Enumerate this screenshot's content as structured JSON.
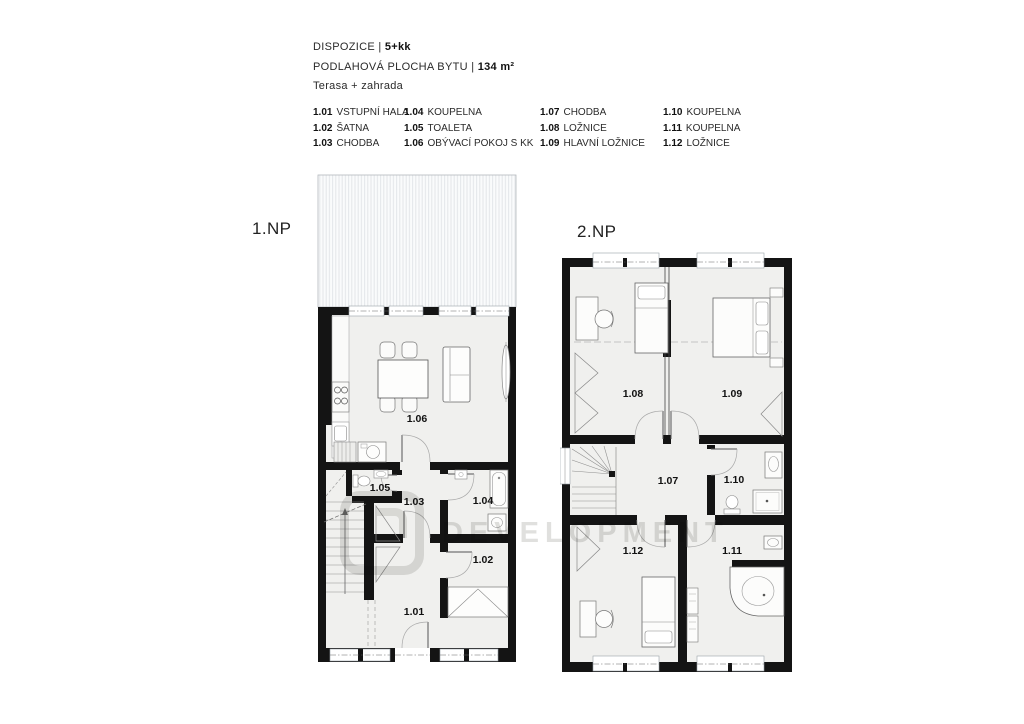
{
  "header": {
    "dispozice_label": "DISPOZICE |",
    "dispozice_value": "5+kk",
    "plocha_label": "PODLAHOVÁ PLOCHA BYTU |",
    "plocha_value": "134 m²",
    "extras": "Terasa + zahrada"
  },
  "legend": {
    "columns": [
      {
        "items": [
          {
            "num": "1.01",
            "name": "VSTUPNÍ HALA"
          },
          {
            "num": "1.02",
            "name": "ŠATNA"
          },
          {
            "num": "1.03",
            "name": "CHODBA"
          }
        ]
      },
      {
        "items": [
          {
            "num": "1.04",
            "name": "KOUPELNA"
          },
          {
            "num": "1.05",
            "name": "TOALETA"
          },
          {
            "num": "1.06",
            "name": "OBÝVACÍ POKOJ S KK"
          }
        ]
      },
      {
        "items": [
          {
            "num": "1.07",
            "name": "CHODBA"
          },
          {
            "num": "1.08",
            "name": "LOŽNICE"
          },
          {
            "num": "1.09",
            "name": "HLAVNÍ LOŽNICE"
          }
        ]
      },
      {
        "items": [
          {
            "num": "1.10",
            "name": "KOUPELNA"
          },
          {
            "num": "1.11",
            "name": "KOUPELNA"
          },
          {
            "num": "1.12",
            "name": "LOŽNICE"
          }
        ]
      }
    ]
  },
  "floors": {
    "floor1": {
      "label": "1.NP",
      "rooms": {
        "r101": "1.01",
        "r102": "1.02",
        "r103": "1.03",
        "r104": "1.04",
        "r105": "1.05",
        "r106": "1.06"
      }
    },
    "floor2": {
      "label": "2.NP",
      "rooms": {
        "r107": "1.07",
        "r108": "1.08",
        "r109": "1.09",
        "r110": "1.10",
        "r111": "1.11",
        "r112": "1.12"
      }
    }
  },
  "watermark": {
    "text": "DEVELOPMENT"
  },
  "colors": {
    "wall": "#141414",
    "room_fill": "#f0f0ee",
    "terrace_stripe": "#e3e6e9",
    "label": "#111111"
  }
}
